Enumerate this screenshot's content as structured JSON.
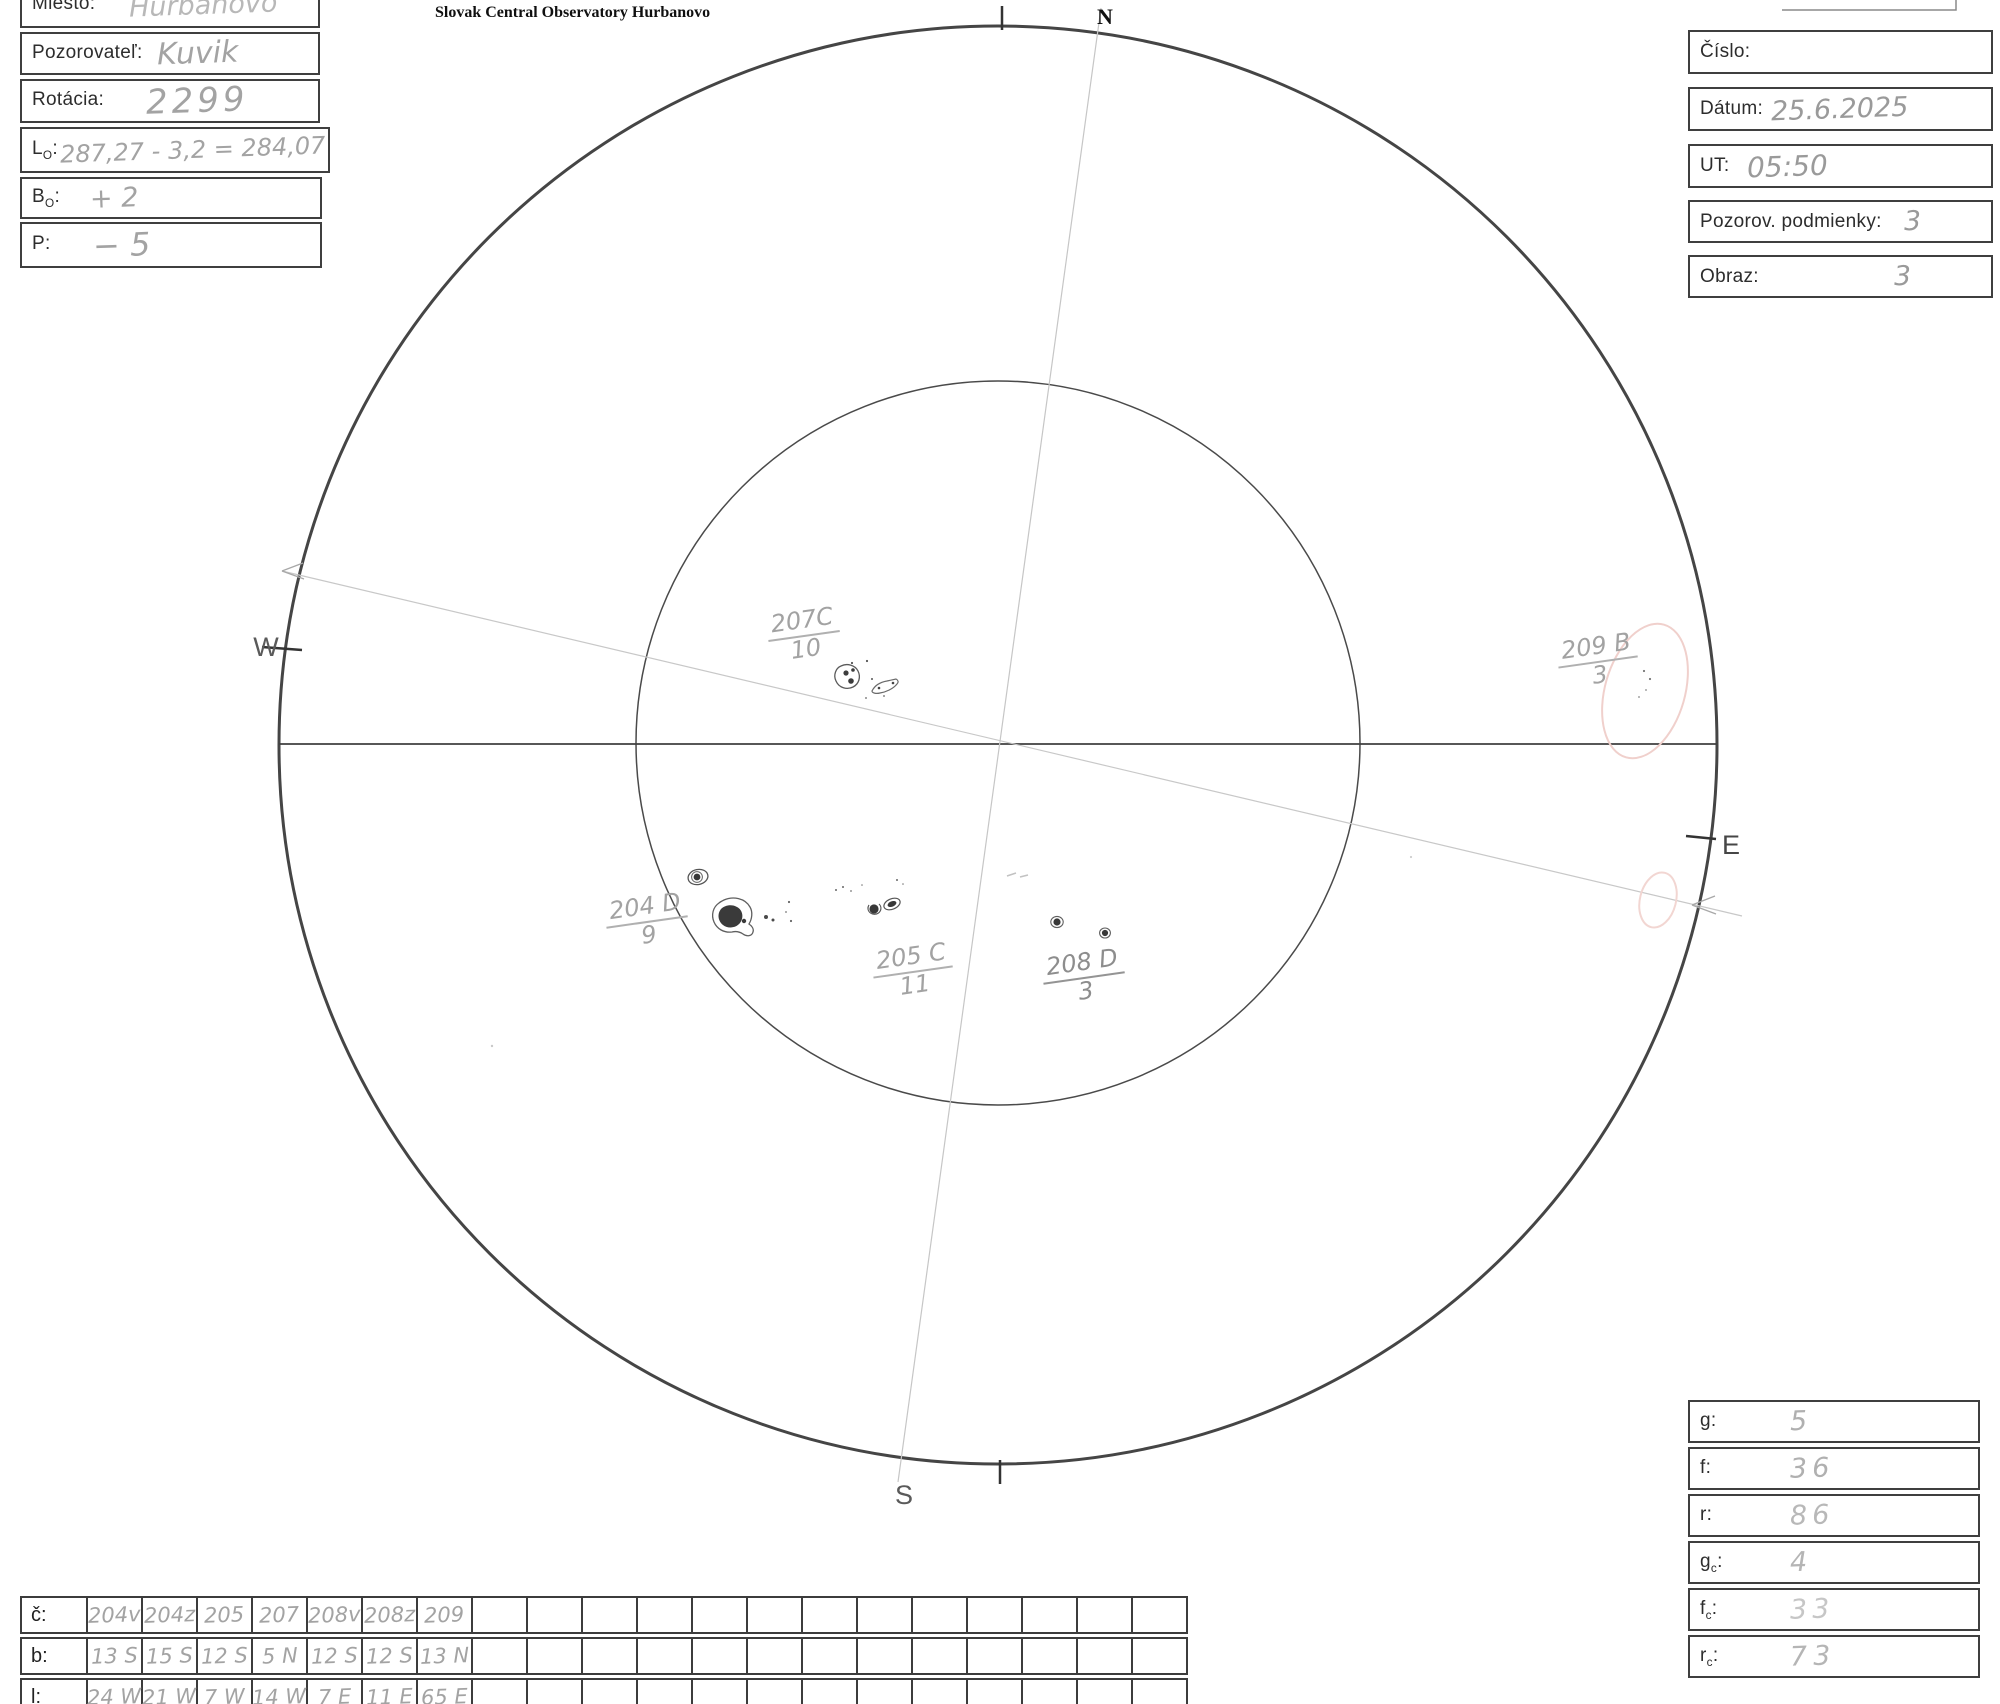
{
  "title": "Slovak Central Observatory Hurbanovo",
  "punct": {
    "colon": ":"
  },
  "form_left": {
    "rows": [
      {
        "base": "Miesto",
        "sub": "",
        "value": "Hurbanovo"
      },
      {
        "base": "Pozorovateľ",
        "sub": "",
        "value": "Kuvik"
      },
      {
        "base": "Rotácia",
        "sub": "",
        "value": "2299"
      },
      {
        "base": "L",
        "sub": "O",
        "value": "287,27 - 3,2 = 284,07"
      },
      {
        "base": "B",
        "sub": "O",
        "value": "+ 2"
      },
      {
        "base": "P",
        "sub": "",
        "value": "− 5"
      }
    ]
  },
  "form_right": {
    "rows": [
      {
        "label": "Číslo:",
        "value": ""
      },
      {
        "label": "Dátum:",
        "value": "25.6.2025"
      },
      {
        "label": "UT:",
        "value": "05:50"
      },
      {
        "label": "Pozorov. podmienky:",
        "value": "3"
      },
      {
        "label": "Obraz:",
        "value": "3"
      }
    ]
  },
  "compass": {
    "n": "N",
    "s": "S",
    "e": "E",
    "w": "W"
  },
  "groups": [
    {
      "id": "207C",
      "count": "10"
    },
    {
      "id": "209 B",
      "count": "3"
    },
    {
      "id": "204 D",
      "count": "9"
    },
    {
      "id": "205 C",
      "count": "11"
    },
    {
      "id": "208 D",
      "count": "3"
    }
  ],
  "stats": {
    "rows": [
      {
        "base": "g",
        "sub": "",
        "value": "5"
      },
      {
        "base": "f",
        "sub": "",
        "value": "36"
      },
      {
        "base": "r",
        "sub": "",
        "value": "86"
      },
      {
        "base": "g",
        "sub": "c",
        "value": "4"
      },
      {
        "base": "f",
        "sub": "c",
        "value": "33"
      },
      {
        "base": "r",
        "sub": "c",
        "value": "73"
      }
    ]
  },
  "bottom_table": {
    "row_labels": [
      "č:",
      "b:",
      "l:"
    ],
    "columns": [
      {
        "c": "204v",
        "b": "13 S",
        "l": "24 W"
      },
      {
        "c": "204z",
        "b": "15 S",
        "l": "21 W"
      },
      {
        "c": "205",
        "b": "12 S",
        "l": "7 W"
      },
      {
        "c": "207",
        "b": "5 N",
        "l": "14 W"
      },
      {
        "c": "208v",
        "b": "12 S",
        "l": "7 E"
      },
      {
        "c": "208z",
        "b": "12 S",
        "l": "11 E"
      },
      {
        "c": "209",
        "b": "13 N",
        "l": "65 E"
      }
    ],
    "empty_columns": 13
  },
  "colors": {
    "pencil": "#a3a3a3",
    "print": "#2d2d2d",
    "disk_outline": "#454545",
    "red_pencil": "#f0d0cc"
  }
}
